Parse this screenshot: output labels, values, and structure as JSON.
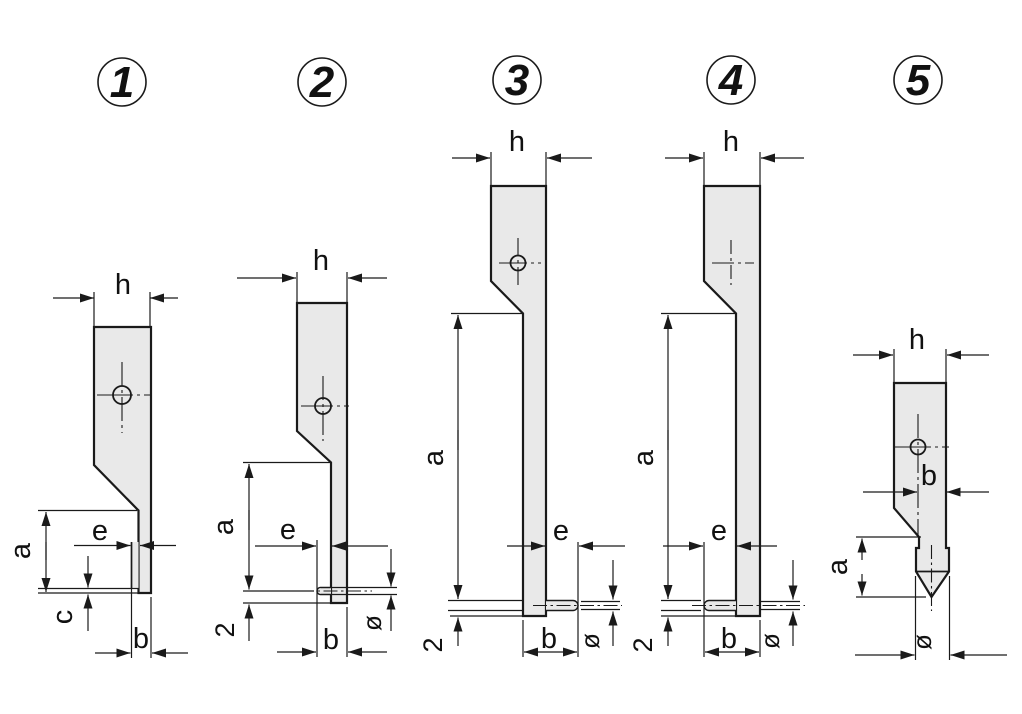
{
  "colors": {
    "fill": "#e9e9e9",
    "line": "#1a1a1a",
    "background": "#ffffff"
  },
  "figures": [
    {
      "number": "1",
      "dims": {
        "h": "h",
        "a": "a",
        "e": "e",
        "c": "c",
        "b": "b"
      }
    },
    {
      "number": "2",
      "dims": {
        "h": "h",
        "a": "a",
        "e": "e",
        "two": "2",
        "b": "b",
        "dia": "ø"
      }
    },
    {
      "number": "3",
      "dims": {
        "h": "h",
        "a": "a",
        "e": "e",
        "two": "2",
        "b": "b",
        "dia": "ø"
      }
    },
    {
      "number": "4",
      "dims": {
        "h": "h",
        "a": "a",
        "e": "e",
        "two": "2",
        "b": "b",
        "dia": "ø"
      }
    },
    {
      "number": "5",
      "dims": {
        "h": "h",
        "b": "b",
        "a": "a",
        "dia": "ø"
      }
    }
  ]
}
